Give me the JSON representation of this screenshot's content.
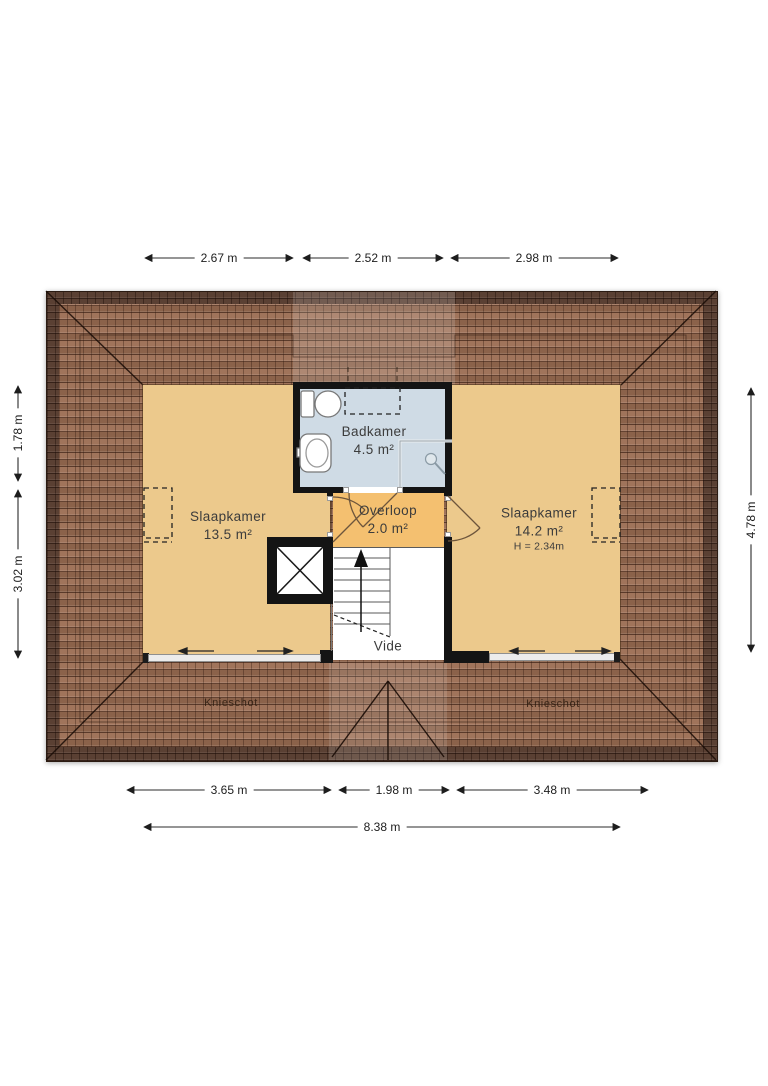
{
  "colors": {
    "room": "#ecc98c",
    "overloop": "#f4c070",
    "bathroom": "#cfdbe5",
    "roof": "#9b6d52",
    "roof_edge": "#5a4033",
    "wall": "#141414",
    "text": "#3c3c3c"
  },
  "rooms": {
    "bedroom_left": {
      "name": "Slaapkamer",
      "area": "13.5 m²"
    },
    "bedroom_right": {
      "name": "Slaapkamer",
      "area": "14.2 m²",
      "height_note": "H = 2.34m"
    },
    "bathroom": {
      "name": "Badkamer",
      "area": "4.5 m²"
    },
    "overloop": {
      "name": "Overloop",
      "area": "2.0 m²"
    },
    "vide": {
      "name": "Vide"
    },
    "knieschot": {
      "name": "Knieschot"
    }
  },
  "dimensions": {
    "top": [
      "2.67 m",
      "2.52 m",
      "2.98 m"
    ],
    "bottom": [
      "3.65 m",
      "1.98 m",
      "3.48 m"
    ],
    "bottom_total": "8.38 m",
    "left": [
      "1.78 m",
      "3.02 m"
    ],
    "right": [
      "4.78 m"
    ]
  }
}
